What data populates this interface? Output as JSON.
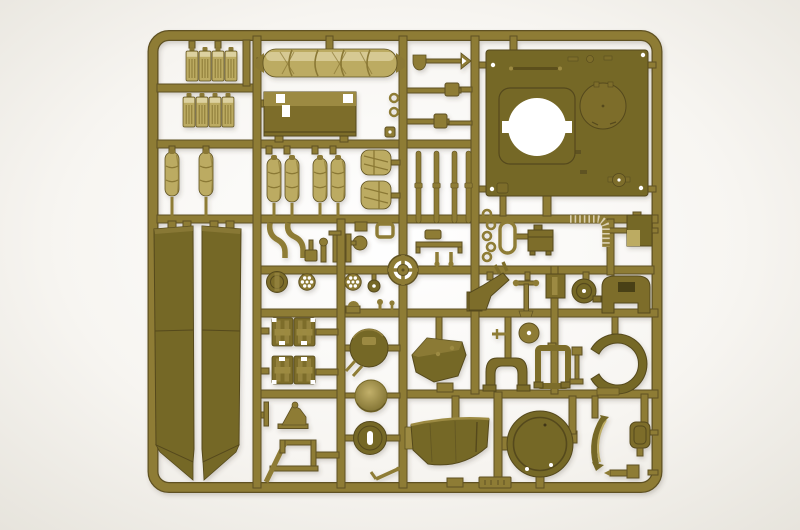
{
  "scene": {
    "subject": "olive-drab-plastic-model-kit-sprue",
    "setting": "white-studio-backdrop"
  },
  "palette": {
    "bg_center": "#ffffff",
    "bg_mid": "#f7f5f1",
    "bg_edge": "#e5e2da",
    "sprue": "#8e7b36",
    "sprue_edge": "#5e5120",
    "sprue_hi": "#b9a65f",
    "part_dark": "#756728",
    "part_dark_edge": "#554a1c",
    "part_mid": "#7d6d2c",
    "part_mid_hi": "#9c8a42",
    "part_light": "#bcab62",
    "part_light_hi": "#dcd1a0",
    "part_light_sh": "#8a7834",
    "dome_hi": "#c2b06a",
    "hole": "#ffffff",
    "shadow": "#4a4030"
  },
  "parts": [
    {
      "name": "outer-frame"
    },
    {
      "name": "runner-grid"
    },
    {
      "name": "jerry-can-row-top",
      "count": 4
    },
    {
      "name": "jerry-can-row-bottom",
      "count": 4
    },
    {
      "name": "bedroll-pair",
      "count": 2
    },
    {
      "name": "tarpaulin-roll"
    },
    {
      "name": "stowage-bin"
    },
    {
      "name": "bedroll-set",
      "count": 4
    },
    {
      "name": "strapped-pack",
      "count": 2
    },
    {
      "name": "side-skirt-left"
    },
    {
      "name": "side-skirt-right"
    },
    {
      "name": "shovel"
    },
    {
      "name": "pioneer-tool",
      "count": 2
    },
    {
      "name": "rod-set",
      "count": 4
    },
    {
      "name": "turret-roof-plate"
    },
    {
      "name": "hatch-opening"
    },
    {
      "name": "hatch-cover"
    },
    {
      "name": "ring-chain",
      "count": 5
    },
    {
      "name": "oval-ring"
    },
    {
      "name": "engine-box"
    },
    {
      "name": "flex-conduit"
    },
    {
      "name": "access-panel"
    },
    {
      "name": "curved-tube",
      "count": 2
    },
    {
      "name": "post-and-disc"
    },
    {
      "name": "knurled-pin"
    },
    {
      "name": "lever"
    },
    {
      "name": "round-hatch-small"
    },
    {
      "name": "spoked-wheel",
      "count": 2
    },
    {
      "name": "hub-wheel"
    },
    {
      "name": "drive-sprocket"
    },
    {
      "name": "stowage-box-pair-upper",
      "count": 2
    },
    {
      "name": "stowage-box-pair-lower",
      "count": 2
    },
    {
      "name": "travel-lock"
    },
    {
      "name": "antenna-frame"
    },
    {
      "name": "cupola-hatch"
    },
    {
      "name": "dome-cover"
    },
    {
      "name": "hatch-with-slot"
    },
    {
      "name": "small-rod"
    },
    {
      "name": "mudguard-bracket"
    },
    {
      "name": "pedestal-mount"
    },
    {
      "name": "slotted-box"
    },
    {
      "name": "cable-drum"
    },
    {
      "name": "seat-back"
    },
    {
      "name": "gun-mantlet"
    },
    {
      "name": "suspension-yoke"
    },
    {
      "name": "rectangular-frame"
    },
    {
      "name": "pole-part"
    },
    {
      "name": "crescent-guard"
    },
    {
      "name": "turret-bustle"
    },
    {
      "name": "hatch-ring-large"
    },
    {
      "name": "curved-sliver"
    },
    {
      "name": "rounded-box"
    },
    {
      "name": "mg-part"
    },
    {
      "name": "sprue-gate-plate",
      "count": 2
    }
  ]
}
